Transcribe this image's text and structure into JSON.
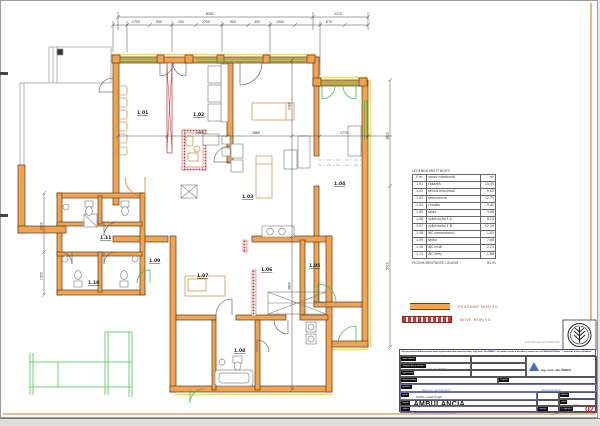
{
  "colors": {
    "wall_existing": "#f0a352",
    "wall_new": "#cc3333",
    "window_green": "#3fbf4f",
    "insulation_yellow": "#f2e35e",
    "accent_purple": "#6a6cb8",
    "title_red": "#cc2222"
  },
  "legend": {
    "title": "LEGENDA MIESTNOSTÍ",
    "headers": {
      "num": "č.m.",
      "name": "názov miestnosti",
      "area": "m²"
    },
    "rooms": [
      {
        "id": "1.01",
        "name": "čakáreň",
        "area": "15.45"
      },
      {
        "id": "1.02",
        "name": "denná miestnosť",
        "area": "9.62"
      },
      {
        "id": "1.03",
        "name": "ambulancia",
        "area": "12.75"
      },
      {
        "id": "1.04",
        "name": "chodba",
        "area": "9.40"
      },
      {
        "id": "1.05",
        "name": "sklad",
        "area": "3.66"
      },
      {
        "id": "1.06",
        "name": "vyšetrovňa 1.2",
        "area": "8.10"
      },
      {
        "id": "1.07",
        "name": "vyšetrovňa 1.B",
        "area": "12.59"
      },
      {
        "id": "1.08",
        "name": "WC zamestnanci",
        "area": "1.65"
      },
      {
        "id": "1.09",
        "name": "šatňa",
        "area": "7.68"
      },
      {
        "id": "1.10",
        "name": "WC muži",
        "area": "2.15"
      },
      {
        "id": "1.11",
        "name": "WC ženy",
        "area": "1.86"
      }
    ],
    "total_label": "PLOCHA MIESTNOSTÍ CELKOM",
    "total": "84.91"
  },
  "wall_legend": {
    "original": "PÔVODNÉ MURIVO",
    "new": "NOVÉ MURIVO"
  },
  "dims": {
    "top_overall": [
      "8255",
      "2170"
    ],
    "top_segments": [
      "1750",
      "900",
      "250",
      "2750",
      "900",
      "350",
      "1500",
      "870"
    ],
    "mid": [
      "2960",
      "2860",
      "1770"
    ],
    "right": [
      "3820",
      "5010"
    ],
    "left": [
      "2200",
      "1500"
    ],
    "center": [
      "2390",
      "3800"
    ]
  },
  "titleblock": {
    "disclaimer": "Táto projektová dokumentácia bola vypracovaná ako autorské dielo - Ing. arch. Ján ŠIMKO. Jej ďalšie šírenie a použitie je možné len so súhlasom autora - © autorské práva vyhradené.",
    "autor_label": "autor návrhu",
    "autor_value": "Ing. arch. Ján ŠIMKO",
    "projektant_label": "zodpovedný projektant",
    "vypracoval_label": "vypracoval",
    "miesto_label": "miesto stavby",
    "miesto_value": "Bánovce nad Bebravou",
    "stupen_label": "stupeň",
    "investor_label": "investor",
    "investor_value": "MUDr. Lukáš Krajčí",
    "akcia_label": "akcia",
    "akcia_value": "AMBULANCIA",
    "obsah_label": "obsah",
    "obsah_value": "architektonicko-stavebné riešenie",
    "format_value": "A4",
    "vykres_label": "výkres",
    "vykres_value": "pôdorys 1.NP - navrhovaný stav",
    "mierka_label": "mierka",
    "mierka_value": "1:50",
    "cislo_label": "č. výkresu",
    "cislo_value": "02",
    "datum_label": "dátum",
    "datum_value": "2023",
    "pare_label": "paré",
    "pare_value": "01",
    "logo_line1": "ateliér architektúry",
    "logo_line2": "Ing. arch. Ján ŠIMKO",
    "logo_line3": "www.jansimko.sk",
    "stamp_caption": "autorizovaný architekt SKA"
  }
}
